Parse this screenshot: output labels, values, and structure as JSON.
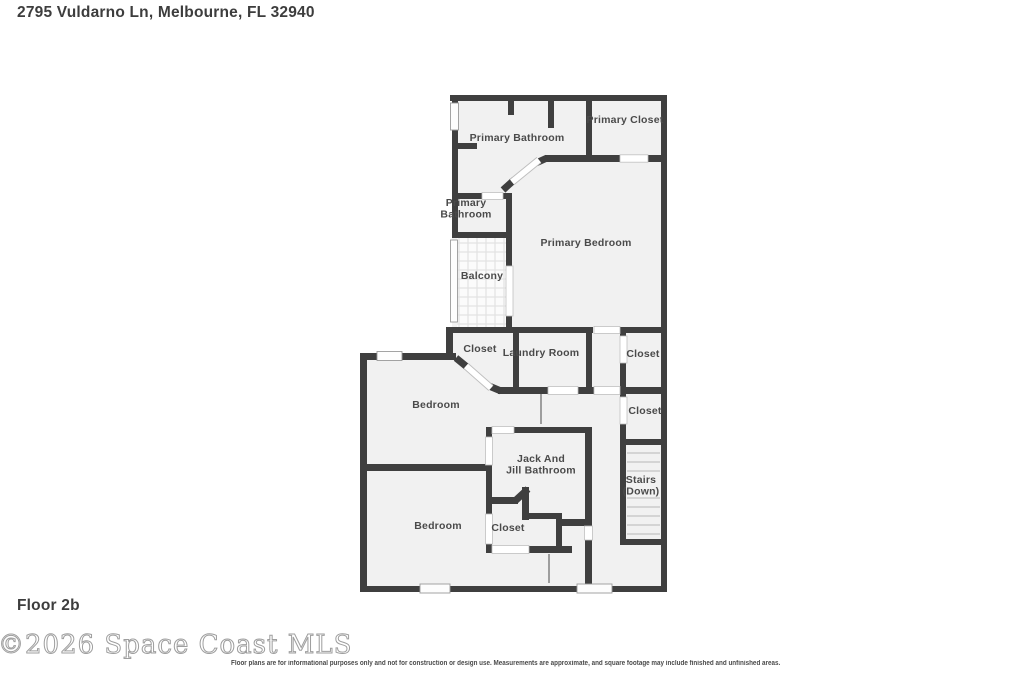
{
  "header": {
    "title": "2795 Vuldarno Ln, Melbourne, FL 32940"
  },
  "footer": {
    "floor_label": "Floor 2b",
    "watermark": "©2026 Space Coast MLS",
    "disclaimer": "Floor plans are for informational purposes only and not for construction or design use. Measurements are approximate, and square footage may include finished and unfinished areas."
  },
  "colors": {
    "wall": "#3f3f3f",
    "room_fill": "#f1f1f1",
    "label_text": "#4a4a4a",
    "watermark_gray": "#9e9e9e",
    "background": "#ffffff"
  },
  "floor_plan": {
    "rooms": [
      {
        "name": "primary-bathroom-main",
        "lines": [
          "Primary Bathroom"
        ],
        "x": 517,
        "y": 141
      },
      {
        "name": "primary-closet",
        "lines": [
          "Primary Closet"
        ],
        "x": 625,
        "y": 123
      },
      {
        "name": "primary-bathroom-small",
        "lines": [
          "Primary",
          "Bathroom"
        ],
        "x": 466,
        "y": 206
      },
      {
        "name": "primary-bedroom",
        "lines": [
          "Primary Bedroom"
        ],
        "x": 586,
        "y": 246
      },
      {
        "name": "balcony",
        "lines": [
          "Balcony"
        ],
        "x": 482,
        "y": 279
      },
      {
        "name": "closet-under-balcony",
        "lines": [
          "Closet"
        ],
        "x": 480,
        "y": 352
      },
      {
        "name": "laundry-room",
        "lines": [
          "Laundry Room"
        ],
        "x": 541,
        "y": 356
      },
      {
        "name": "closet-right-upper",
        "lines": [
          "Closet"
        ],
        "x": 643,
        "y": 357
      },
      {
        "name": "closet-right-lower",
        "lines": [
          "Closet"
        ],
        "x": 645,
        "y": 414
      },
      {
        "name": "bedroom-upper",
        "lines": [
          "Bedroom"
        ],
        "x": 436,
        "y": 408
      },
      {
        "name": "jack-and-jill-bathroom",
        "lines": [
          "Jack And",
          "Jill Bathroom"
        ],
        "x": 541,
        "y": 462
      },
      {
        "name": "stairs-down",
        "lines": [
          "Stairs",
          "(Down)"
        ],
        "x": 641,
        "y": 483
      },
      {
        "name": "bedroom-lower",
        "lines": [
          "Bedroom"
        ],
        "x": 438,
        "y": 529
      },
      {
        "name": "closet-jack-and-jill",
        "lines": [
          "Closet"
        ],
        "x": 508,
        "y": 531
      }
    ]
  }
}
